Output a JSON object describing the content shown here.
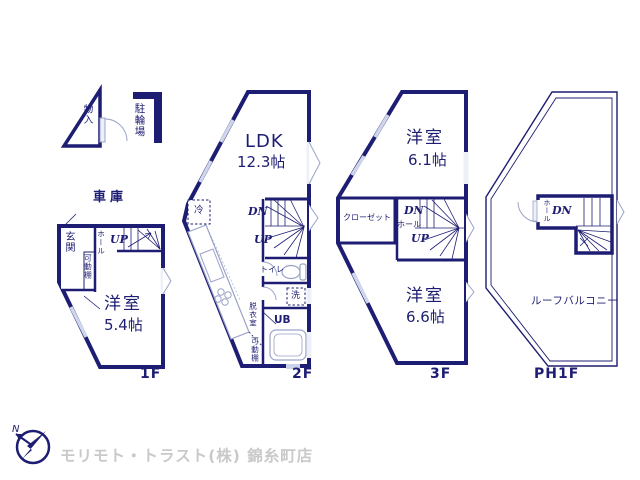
{
  "colors": {
    "wall": "#1d1d73",
    "room_fill": "#fbf1d3",
    "closet_fill": "#f7dce3",
    "window_fill": "#dfe4f2",
    "fixture_line": "#9aa3c6",
    "brand_text": "#c9c9c9"
  },
  "floors": [
    {
      "name": "1F",
      "labels": {
        "storage": "物入",
        "bicycle_parking": "駐輪場",
        "garage": "車庫",
        "entrance": "玄関",
        "hall": "ホール",
        "up": "UP",
        "shelf": "可動棚",
        "room": "洋室",
        "room_size": "5.4帖"
      }
    },
    {
      "name": "2F",
      "labels": {
        "ldk": "LDK",
        "ldk_size": "12.3帖",
        "fridge": "冷",
        "dn": "DN",
        "up": "UP",
        "toilet": "トイレ",
        "laundry": "洗",
        "bath": "UB",
        "dressing_room": "脱衣室",
        "shelf": "可動棚"
      }
    },
    {
      "name": "3F",
      "labels": {
        "room_upper": "洋室",
        "room_upper_size": "6.1帖",
        "closet": "クローゼット",
        "dn": "DN",
        "hall": "ホール",
        "up": "UP",
        "room_lower": "洋室",
        "room_lower_size": "6.6帖"
      }
    },
    {
      "name": "PH1F",
      "labels": {
        "hall": "ホール",
        "dn": "DN",
        "roof_balcony": "ルーフバルコニー"
      }
    }
  ],
  "branding": {
    "north_mark": "N",
    "company": "モリモト・トラスト(株) 錦糸町店"
  }
}
